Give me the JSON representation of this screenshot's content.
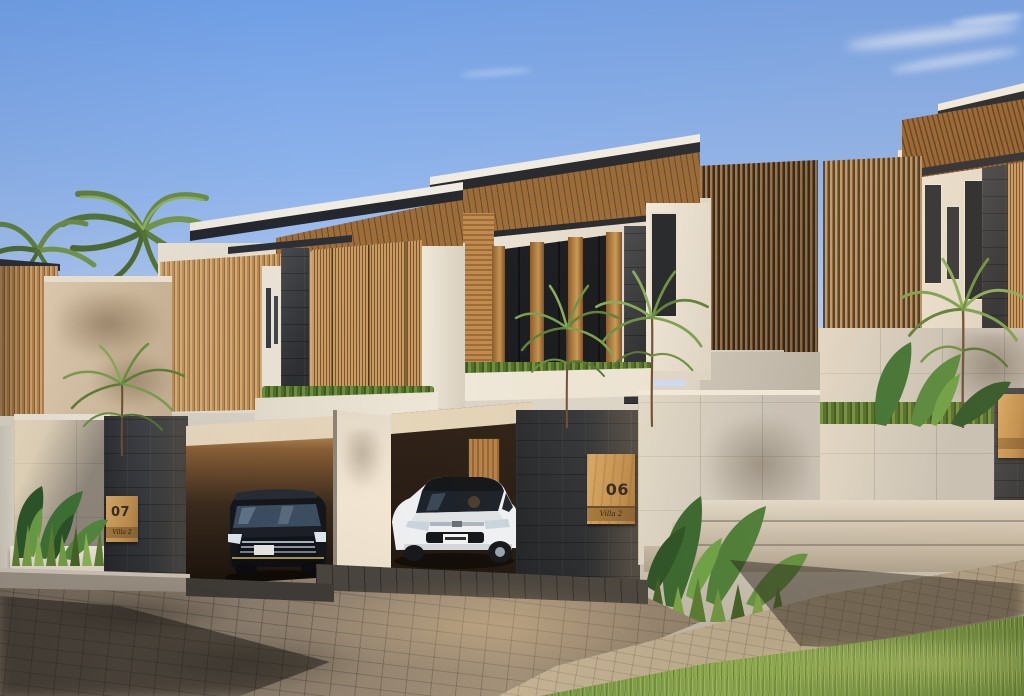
{
  "signs": {
    "left": {
      "number": "07",
      "caption": "Villa 2"
    },
    "center": {
      "number": "06",
      "caption": "Villa 2"
    },
    "right": {
      "number": "",
      "caption": ""
    }
  },
  "vehicles": [
    {
      "name": "black-minivan",
      "location": "left-garage"
    },
    {
      "name": "white-suv",
      "location": "center-garage"
    }
  ],
  "palette": {
    "sky_top": "#6f9ee5",
    "sky_horizon": "#e9eef7",
    "wood_light": "#d4a873",
    "wood_mid": "#b5854b",
    "wood_dark": "#7a5128",
    "roof_fascia": "#24272d",
    "stucco_white": "#efe8db",
    "concrete_panel": "#d6d0c5",
    "stone_dark": "#3a3d41",
    "foliage_green": "#5e7d3a",
    "grass_green": "#6d8c3c",
    "paver_tan": "#97856c",
    "shadow_brown": "#4a453e",
    "minivan_black": "#15171b",
    "suv_white": "#eef0f2"
  }
}
